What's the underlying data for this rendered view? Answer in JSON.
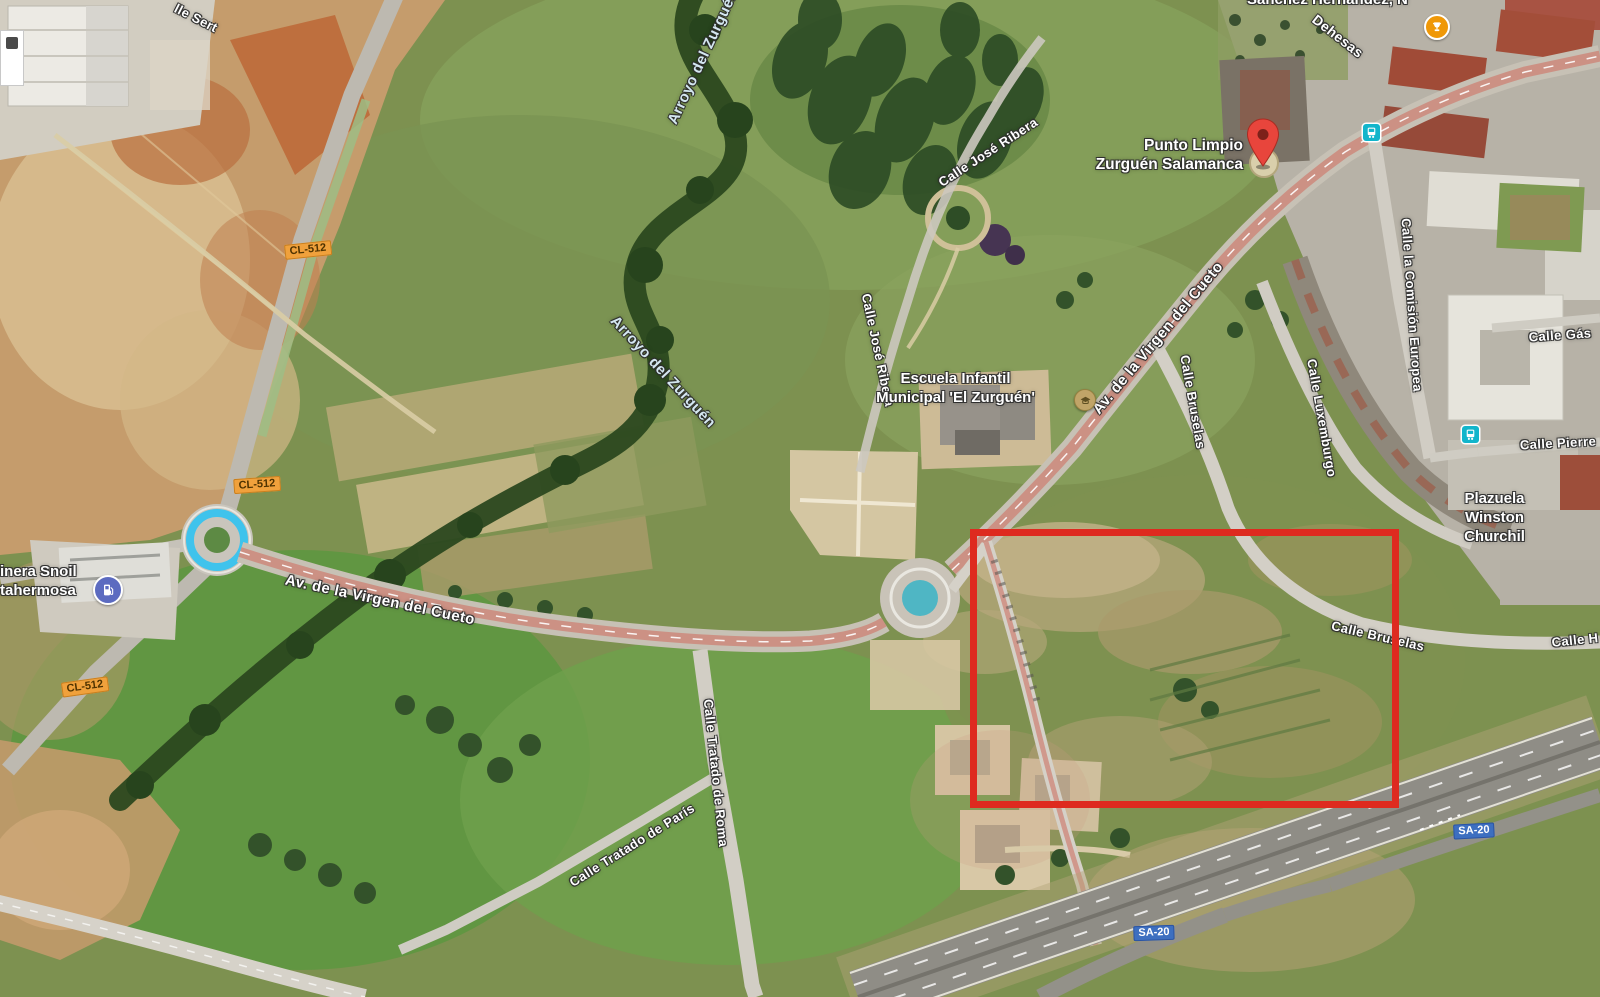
{
  "colors": {
    "annotation_red": "#de2a1f",
    "shield_orange_bg": "#f0a13c",
    "shield_orange_text": "#4f3300",
    "shield_blue_bg": "#3d6fc0",
    "shield_blue_text": "#ffffff",
    "pin_red": "#e8453c",
    "transit_teal": "#12b5cb",
    "gas_icon_purple": "#5c6bc0",
    "poi_orange": "#ef9808"
  },
  "pois": {
    "punto_limpio": {
      "line1": "Punto Limpio",
      "line2": "Zurguén Salamanca"
    },
    "escuela": {
      "line1": "Escuela Infantil",
      "line2": "Municipal 'El Zurguén'"
    },
    "plazuela": {
      "line1": "Plazuela",
      "line2": "Winston",
      "line3": "Churchil"
    },
    "gasolinera": {
      "line1": "inera Snoil",
      "line2": "tahermosa"
    },
    "sanchez": {
      "text": "Sánchez Hernández, N"
    }
  },
  "street_labels": [
    {
      "name": "calle-sert",
      "text": "lle Sert",
      "x": 196,
      "y": 18,
      "rot": 27,
      "size": 13,
      "kind": "street"
    },
    {
      "name": "dehesas",
      "text": "Dehesas",
      "x": 1338,
      "y": 36,
      "rot": 38,
      "size": 14,
      "kind": "street"
    },
    {
      "name": "arroyo-del-zurguen-north",
      "text": "Arroyo del Zurguén",
      "x": 703,
      "y": 57,
      "rot": -65,
      "size": 15,
      "kind": "water"
    },
    {
      "name": "arroyo-del-zurguen-mid",
      "text": "Arroyo del Zurguén",
      "x": 663,
      "y": 372,
      "rot": 47,
      "size": 15,
      "kind": "water"
    },
    {
      "name": "calle-jose-ribera-north",
      "text": "Calle José Ribera",
      "x": 988,
      "y": 152,
      "rot": -33,
      "size": 13,
      "kind": "street"
    },
    {
      "name": "calle-jose-ribera-south",
      "text": "Calle José Ribera",
      "x": 878,
      "y": 350,
      "rot": 78,
      "size": 13,
      "kind": "street"
    },
    {
      "name": "av-virgen-del-cueto-upper",
      "text": "Av. de la Virgen del Cueto",
      "x": 1158,
      "y": 338,
      "rot": -50,
      "size": 15,
      "kind": "street"
    },
    {
      "name": "av-virgen-del-cueto-lower",
      "text": "Av. de la Virgen del Cueto",
      "x": 380,
      "y": 600,
      "rot": 12,
      "size": 15,
      "kind": "street"
    },
    {
      "name": "calle-bruselas-north",
      "text": "Calle Bruselas",
      "x": 1193,
      "y": 402,
      "rot": 80,
      "size": 13,
      "kind": "street"
    },
    {
      "name": "calle-bruselas-east",
      "text": "Calle Bruselas",
      "x": 1378,
      "y": 636,
      "rot": 13,
      "size": 13,
      "kind": "street"
    },
    {
      "name": "calle-luxemburgo",
      "text": "Calle Luxemburgo",
      "x": 1322,
      "y": 418,
      "rot": 80,
      "size": 13,
      "kind": "street"
    },
    {
      "name": "calle-la-comision-europea",
      "text": "Calle la Comisión Europea",
      "x": 1412,
      "y": 305,
      "rot": 86,
      "size": 13,
      "kind": "street"
    },
    {
      "name": "calle-gas",
      "text": "Calle Gás",
      "x": 1560,
      "y": 335,
      "rot": -4,
      "size": 13,
      "kind": "street"
    },
    {
      "name": "calle-pierre",
      "text": "Calle Pierre",
      "x": 1558,
      "y": 443,
      "rot": -3,
      "size": 13,
      "kind": "street"
    },
    {
      "name": "calle-h",
      "text": "Calle H",
      "x": 1575,
      "y": 640,
      "rot": -6,
      "size": 13,
      "kind": "street"
    },
    {
      "name": "calle-tratado-de-roma",
      "text": "Calle Tratado de Roma",
      "x": 716,
      "y": 773,
      "rot": 84,
      "size": 13,
      "kind": "street"
    },
    {
      "name": "calle-tratado-de-paris",
      "text": "Calle Tratado de París",
      "x": 632,
      "y": 845,
      "rot": -32,
      "size": 13,
      "kind": "street"
    }
  ],
  "road_shields": [
    {
      "text": "CL-512",
      "type": "orange",
      "x": 308,
      "y": 250,
      "rot": -6
    },
    {
      "text": "CL-512",
      "type": "orange",
      "x": 257,
      "y": 485,
      "rot": -4
    },
    {
      "text": "CL-512",
      "type": "orange",
      "x": 85,
      "y": 687,
      "rot": -8
    },
    {
      "text": "SA-20",
      "type": "blue",
      "x": 1154,
      "y": 933,
      "rot": -2
    },
    {
      "text": "SA-20",
      "type": "blue",
      "x": 1474,
      "y": 831,
      "rot": -3
    }
  ],
  "icons": {
    "pin": "red-map-pin",
    "bus_stop": "bus-stop-icon",
    "transit": "transit-stop-icon",
    "trophy": "trophy-poi-icon",
    "gas": "gas-station-icon",
    "school": "school-poi-icon"
  }
}
